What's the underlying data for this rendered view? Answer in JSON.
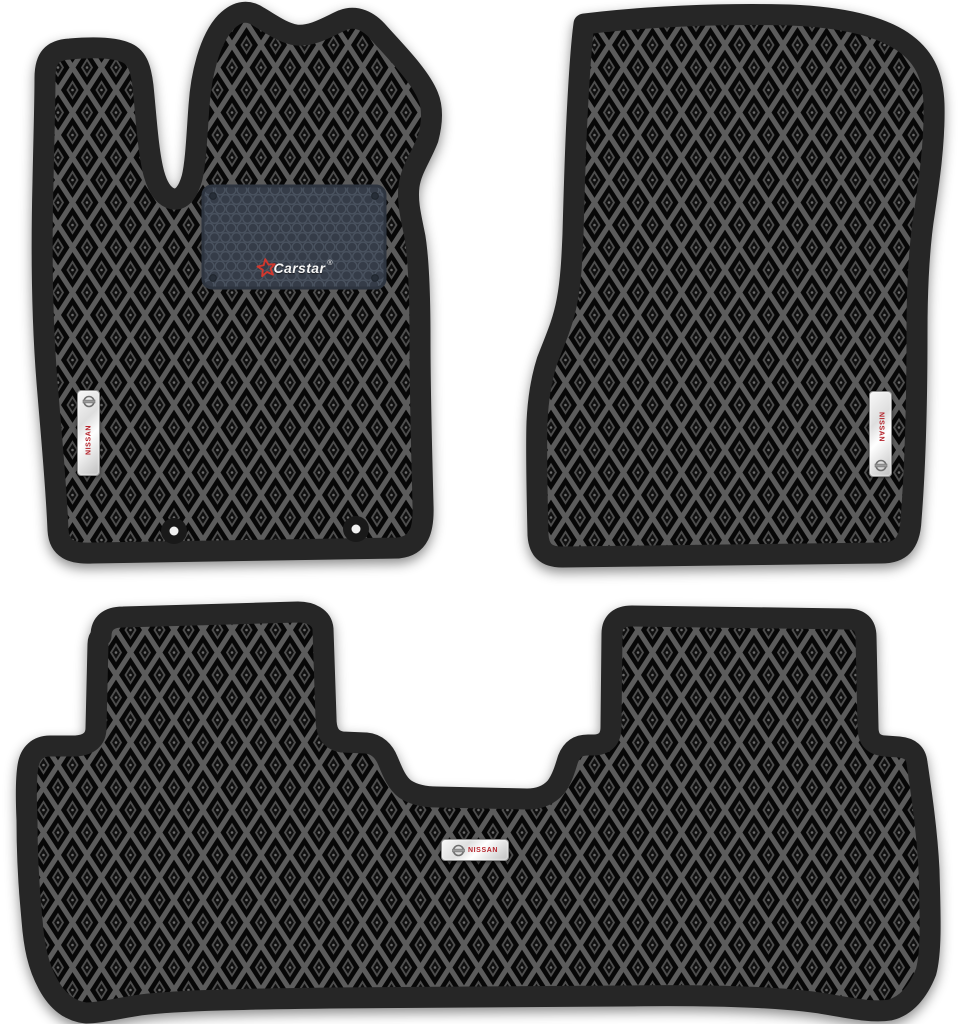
{
  "product": {
    "title": "nissan-eva-floor-mats-set",
    "brand_label": {
      "text": "Carstar",
      "registered_mark": "®",
      "star_icon": "star-outline",
      "star_color": "#d2382e",
      "text_color": "#f5f5f5"
    },
    "badges": {
      "driver": "NISSAN",
      "passenger": "NISSAN",
      "rear": "NISSAN",
      "emblem_icon": "nissan-circle-bar",
      "text_color": "#b5232b"
    },
    "mats": [
      {
        "id": "driver-front-mat",
        "features": [
          "heel-pad",
          "two-fastener-clips",
          "vertical-nissan-badge"
        ]
      },
      {
        "id": "passenger-front-mat",
        "features": [
          "vertical-nissan-badge"
        ]
      },
      {
        "id": "rear-row-mat",
        "features": [
          "tunnel-cutout",
          "horizontal-nissan-badge"
        ]
      }
    ],
    "colors": {
      "background": "#ffffff",
      "mat_base": "#070707",
      "lattice": "#5c5c5c",
      "edging": "#262626",
      "heel_pad_base": "#353c48",
      "heel_pad_cells": "#49525f"
    }
  }
}
